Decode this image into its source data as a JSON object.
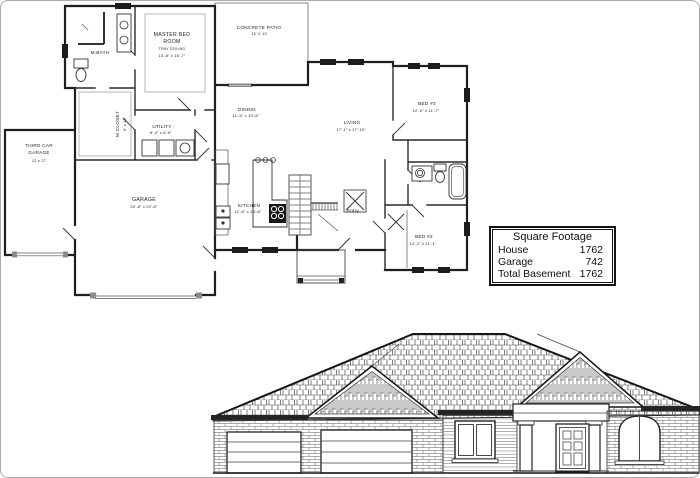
{
  "sheet": {
    "paper_color": "#ffffff",
    "ink_color": "#1c1c1c",
    "frame_color": "#ababab"
  },
  "sqft_table": {
    "title": "Square Footage",
    "rows": [
      {
        "label": "House",
        "value": "1762"
      },
      {
        "label": "Garage",
        "value": "742"
      },
      {
        "label": "Total Basement",
        "value": "1762"
      }
    ]
  },
  "rooms": {
    "master_bed": {
      "line1": "MASTER BED",
      "line2": "ROOM",
      "ceiling": "TRAY CEILING",
      "dims": "13'-8\" x 16'-7\""
    },
    "concrete_patio": {
      "name": "CONCRETE PATIO",
      "dims": "15' X 13"
    },
    "m_bath": {
      "name": "M.BATH"
    },
    "m_closet": {
      "name": "M.CLOSET",
      "dims": "6' x 13'"
    },
    "third_car_garage": {
      "line1": "THIRD CAR",
      "line2": "GARAGE",
      "dims": "12 x 27"
    },
    "garage": {
      "name": "GARAGE",
      "dims": "22'-8\" x 22'-8\""
    },
    "utility": {
      "name": "UTILITY",
      "dims": "8'-4\" x 6'-8\""
    },
    "kitchen": {
      "name": "KITCHEN",
      "dims": "11'-8\" x 13'-8\""
    },
    "dining": {
      "name": "DINING",
      "dims": "11'-6\" x 10'-8\""
    },
    "living": {
      "name": "LIVING",
      "dims": "17'-1\" x 17'-10\""
    },
    "entry": {
      "name": "Entry"
    },
    "bed3": {
      "name": "BED #3",
      "dims": "12'-0\" x 11'-7\""
    },
    "bed2": {
      "name": "BED #2",
      "dims": "12'-2\" x 11'-1\""
    }
  }
}
